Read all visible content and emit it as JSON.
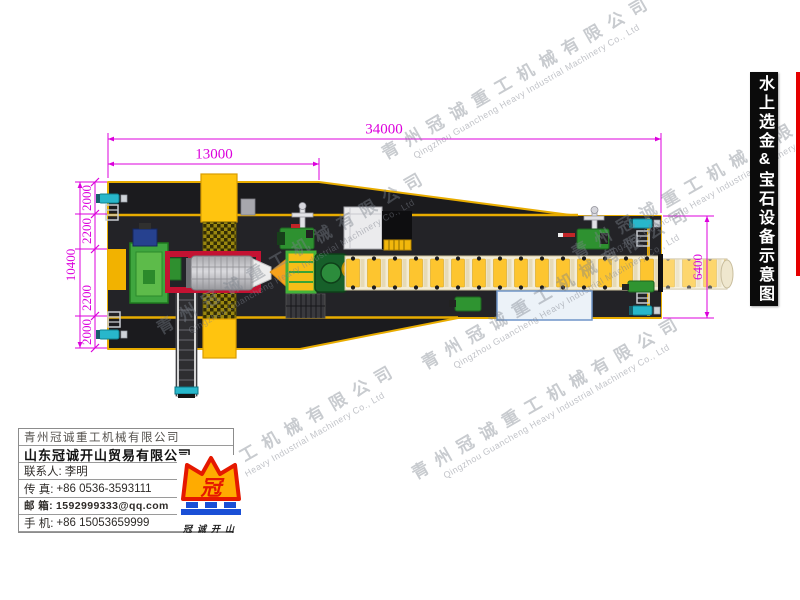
{
  "title_banner": {
    "text": "水上选金&宝石设备示意图"
  },
  "dimensions": {
    "total_length": "34000",
    "front_section_length": "13000",
    "hull_width_total": "10400",
    "stern_width": "6400",
    "port_outer": "2000",
    "port_inner": "2200",
    "starboard_inner": "2200",
    "starboard_outer": "2000"
  },
  "watermark": {
    "cn": "青州冠诚重工机械有限公司",
    "en": "Qingzhou Guancheng Heavy Industrial Machinery Co., Ltd"
  },
  "company_box": {
    "company_primary": "青州冠诚重工机械有限公司",
    "company_secondary": "山东冠诚开山贸易有限公司",
    "contact_label": "联系人:",
    "contact_value": "李明",
    "fax_label": "传  真:",
    "fax_value": "+86 0536-3593111",
    "email_label": "邮  箱:",
    "email_value": "1592999333@qq.com",
    "mobile_label": "手  机:",
    "mobile_value": "+86 15053659999",
    "logo_mark": "冠",
    "logo_caption": "冠诚开山"
  },
  "colors": {
    "dimension": "#DC00DC",
    "hull": "#1B1B1E",
    "deck_stripe": "#E8AC00",
    "hopper": "#FFC40F",
    "trommel_frame": "#C41232",
    "machine_green": "#2E9130",
    "pump_teal": "#28B7CB",
    "sluice_gold": "#FDC52F",
    "pool_fill": "#ECF2F8",
    "accent_red": "#E60000",
    "banner_bg": "#0B0B0B",
    "logo_orange": "#FFAB00",
    "logo_red": "#E51800",
    "logo_blue": "#1A4FD6"
  }
}
